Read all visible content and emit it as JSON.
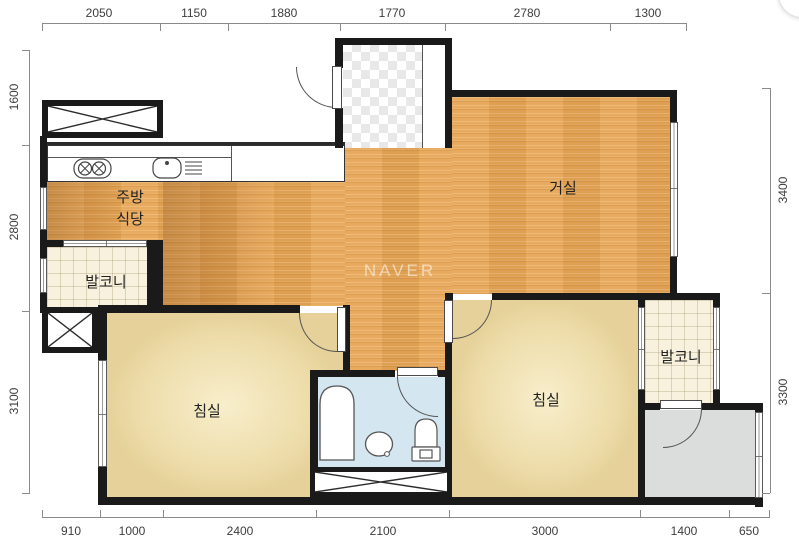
{
  "watermark": "NAVER",
  "rooms": {
    "kitchen_dining": "주방\n식당",
    "living": "거실",
    "balcony_left": "발코니",
    "balcony_right": "발코니",
    "bedroom_left": "침실",
    "bedroom_right": "침실"
  },
  "dimensions": {
    "top": [
      "2050",
      "1150",
      "1880",
      "1770",
      "2780",
      "1300"
    ],
    "bottom": [
      "910",
      "1000",
      "2400",
      "2100",
      "3000",
      "1400",
      "650"
    ],
    "left": [
      "1600",
      "2800",
      "3100"
    ],
    "right": [
      "3400",
      "3300"
    ]
  },
  "colors": {
    "wall": "#1a1a1a",
    "wood": "#e7a655",
    "bedroom": "#eddca9",
    "balcony": "#f8f1de",
    "bathroom": "#d4e7f1",
    "utility": "#dbdcdc"
  }
}
